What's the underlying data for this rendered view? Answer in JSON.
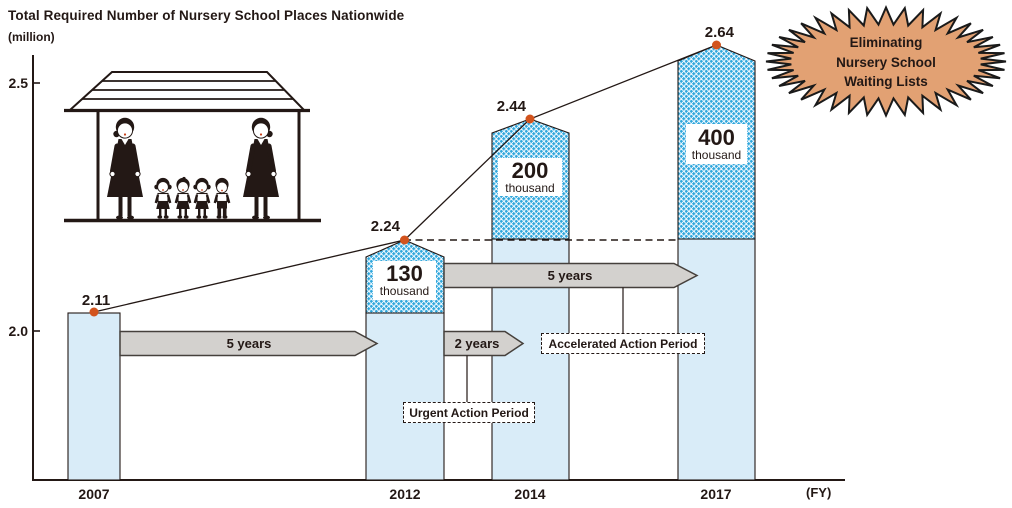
{
  "chart": {
    "title": "Total Required Number of Nursery School Places Nationwide",
    "unit_label": "(million)",
    "fy_label": "(FY)",
    "y_tick_labels": [
      "2.5",
      "2.0"
    ],
    "value_labels": [
      "2.11",
      "2.24",
      "2.44",
      "2.64"
    ]
  },
  "chart_data": {
    "type": "bar",
    "title": "Total Required Number of Nursery School Places Nationwide",
    "ylabel": "(million)",
    "xlabel": "(FY)",
    "categories": [
      "2007",
      "2012",
      "2014",
      "2017"
    ],
    "values": [
      2.11,
      2.24,
      2.44,
      2.64
    ],
    "y_ticks": [
      2.0,
      2.5
    ],
    "dashed_reference_level": 2.24,
    "increases": [
      {
        "category": "2012",
        "amount": "130",
        "unit": "thousand",
        "value_million": 0.13
      },
      {
        "category": "2014",
        "amount": "200",
        "unit": "thousand",
        "value_million": 0.2
      },
      {
        "category": "2017",
        "amount": "400",
        "unit": "thousand",
        "value_million": 0.4
      }
    ],
    "grid": false,
    "legend_position": "none"
  },
  "annotations": {
    "arrow_1": "5 years",
    "arrow_2": "2 years",
    "arrow_3": "5 years",
    "urgent_box": "Urgent Action Period",
    "accelerated_box": "Accelerated Action Period"
  },
  "badge": {
    "lines": [
      "Eliminating",
      "Nursery School",
      "Waiting Lists"
    ],
    "fill_color": "#E2A173"
  }
}
